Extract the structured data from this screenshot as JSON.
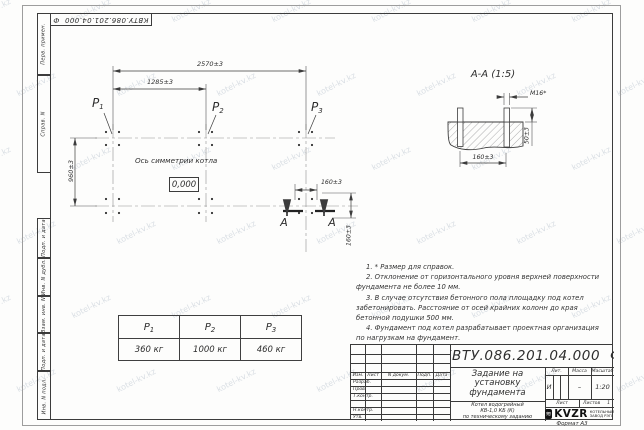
{
  "watermark": {
    "text": "kotel-kv.kz"
  },
  "stamp": {
    "doc_number_flipped": "КВТУ.086.201.04.000  Ф"
  },
  "sidebar": {
    "labels": [
      "Перв. примен.",
      "Справ. N",
      "Подп. и дата",
      "Инв. N дубл.",
      "Взам. инв. N",
      "Подп. и дата",
      "Инв. N подл."
    ]
  },
  "plan": {
    "dims": {
      "width_total": "2570±3",
      "width_half": "1285±3",
      "depth": "960±3",
      "offset_x": "160±3",
      "offset_y": "160±3"
    },
    "labels": [
      {
        "base": "P",
        "sub": "1"
      },
      {
        "base": "P",
        "sub": "2"
      },
      {
        "base": "P",
        "sub": "3"
      }
    ],
    "axis_label": "Ось симметрии котла",
    "elevation": "0,000",
    "section_mark": "А"
  },
  "section_view": {
    "title": "А-А (1:5)",
    "thread": "М16*",
    "dim_height": "50±3",
    "dim_width": "160±3"
  },
  "notes": [
    "1. * Размер для справок.",
    "2. Отклонение от горизонтального уровня верхней поверхности фундамента не более 10 мм.",
    "3. В случае отсутствия бетонного пола площадку под котел забетонировать. Расстояние от осей крайних колонн до края бетонной подушки 500 мм.",
    "4. Фундамент под котел разрабатывает проектная организация по нагрузкам на фундамент."
  ],
  "load_table": {
    "headers": [
      {
        "base": "P",
        "sub": "1"
      },
      {
        "base": "P",
        "sub": "2"
      },
      {
        "base": "P",
        "sub": "3"
      }
    ],
    "values": [
      "360 кг",
      "1000 кг",
      "460 кг"
    ]
  },
  "title_block": {
    "doc_number": "КВТУ.086.201.04.000  Ф",
    "columns": {
      "izm": "Изм.",
      "list": "Лист",
      "doc": "N докум.",
      "podp": "Подп.",
      "data": "Дата"
    },
    "rows": {
      "razrab": "Разраб.",
      "prov": "Пров.",
      "tkontr": "Т.контр.",
      "nkontr": "Н.контр.",
      "utv": "Утв."
    },
    "title": "Задание на установку фундамента",
    "subtitle_lines": [
      "Котел водогрейный",
      "КВ-1,0 КБ (К)",
      "по техническому заданию"
    ],
    "lit_label": "Лит.",
    "lit_value": "И",
    "mass_label": "Масса",
    "mass_value": "–",
    "scale_label": "Масштаб",
    "scale_value": "1:20",
    "sheet_label": "Лист",
    "sheets_label": "Листов",
    "sheets_value": "1",
    "logo": {
      "text": "KVZR",
      "company_line1": "КОТЕЛЬНЫЙ",
      "company_line2": "ЗАВОД РЭП"
    },
    "format": "Формат А3"
  }
}
